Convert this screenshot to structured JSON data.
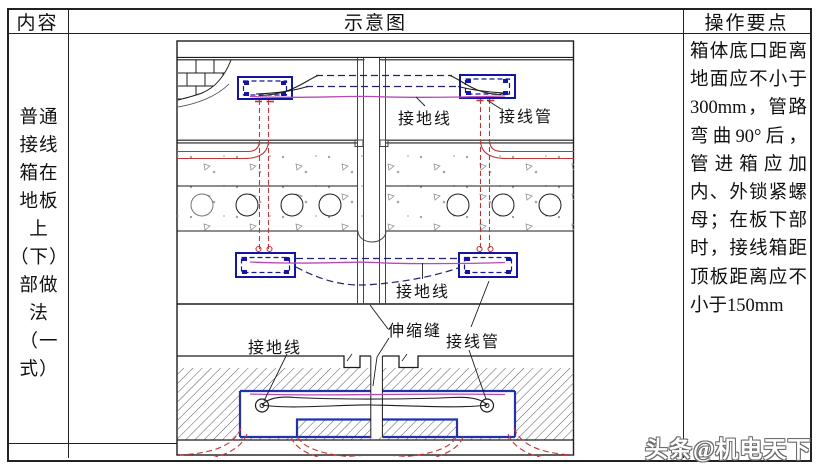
{
  "table": {
    "header": {
      "col1": "内容",
      "col2": "示意图",
      "col3": "操作要点"
    },
    "content_cell": {
      "text": "普通\n接线\n箱在\n地板\n上\n（下）\n部做\n法\n（一\n式）"
    },
    "notes_cell": {
      "text": "箱体底口距离地面应不小于300mm，管路弯曲90°后，管进箱应加内、外锁紧螺母；在板下部时，接线箱距顶板距离应不小于150mm"
    }
  },
  "diagram": {
    "labels": {
      "ground_wire_top": "接地线",
      "conduit_top": "接线管",
      "ground_wire_mid": "接地线",
      "expansion_joint": "伸缩缝",
      "conduit_bottom": "接线管",
      "ground_wire_bottom": "接地线"
    }
  },
  "watermark": {
    "text": "头条@机电天下"
  },
  "colors": {
    "box_outline": "#1515a3",
    "conduit_red": "#c23535",
    "wire_magenta": "#b84ab8",
    "dashed_wire": "#232370",
    "line_dark": "#1d1d1d",
    "table_line": "#222222",
    "hatch_gray": "#5a5a5a"
  }
}
